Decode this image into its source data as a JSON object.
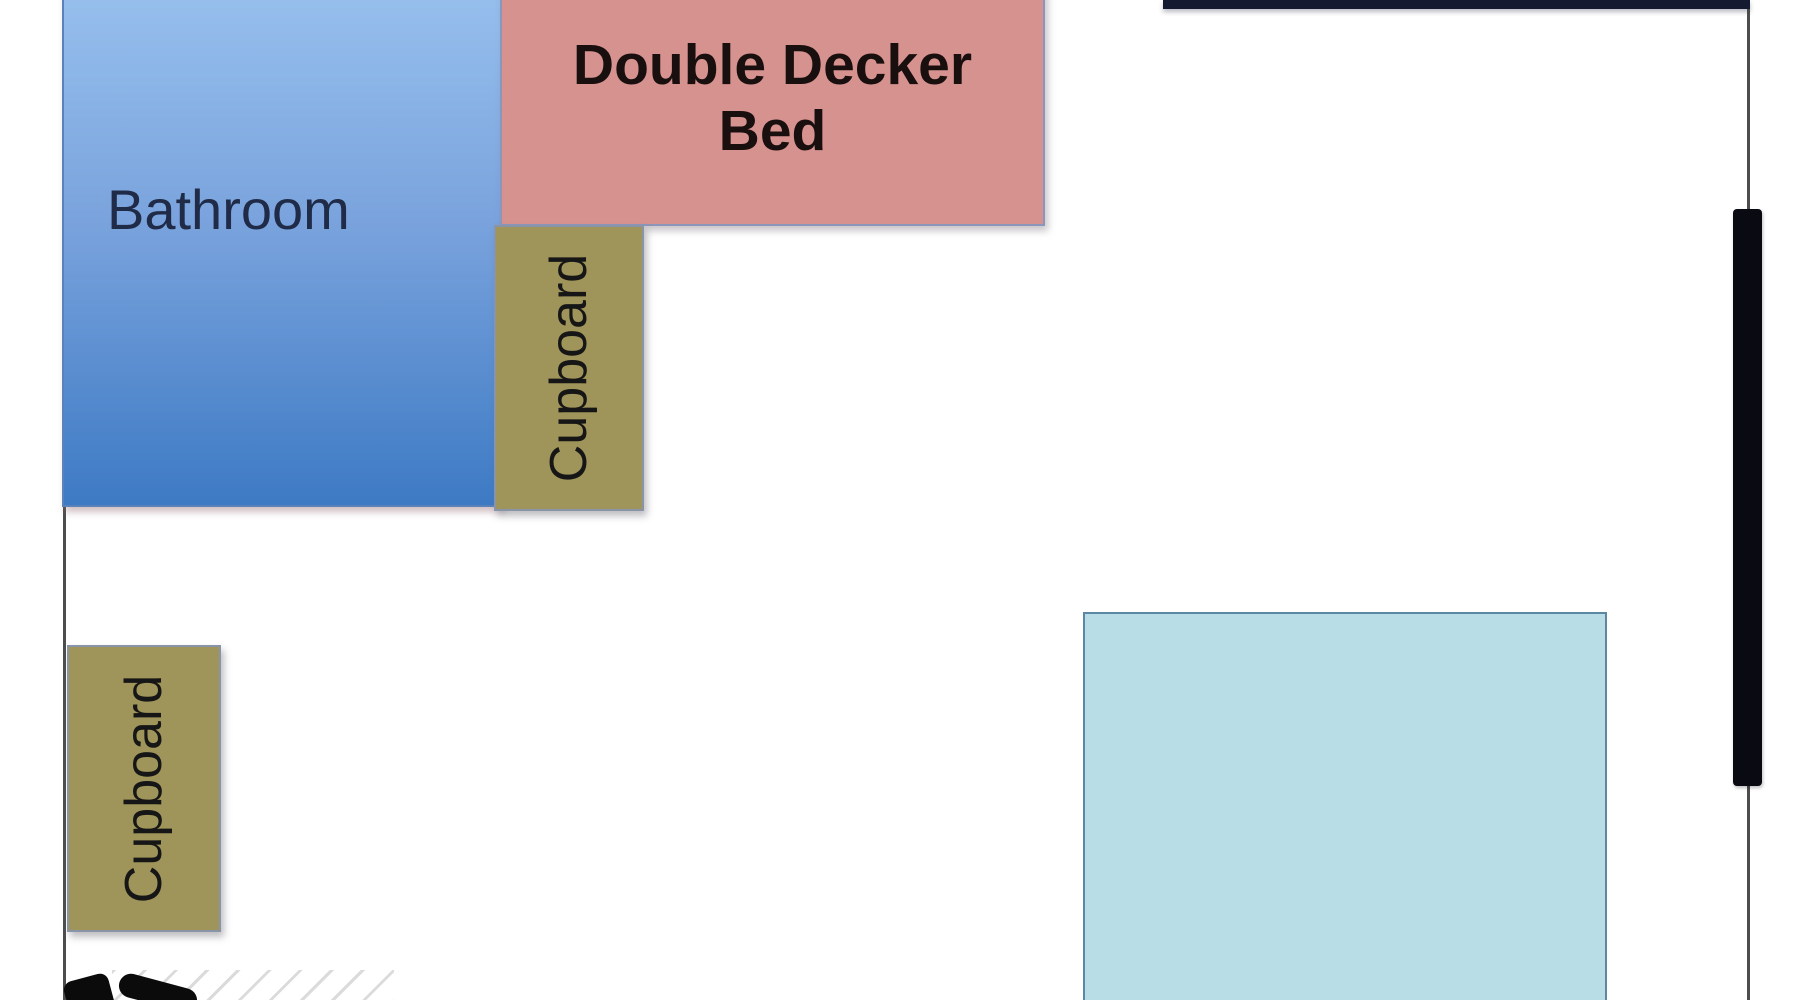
{
  "diagram": {
    "type": "floor-plan",
    "rooms": [
      {
        "id": "bathroom",
        "label": "Bathroom"
      }
    ],
    "furniture": [
      {
        "id": "double-decker-bed",
        "label": "Double Decker Bed"
      },
      {
        "id": "cupboard-right",
        "label": "Cupboard"
      },
      {
        "id": "cupboard-left",
        "label": "Cupboard"
      },
      {
        "id": "unlabeled-area",
        "label": ""
      }
    ],
    "symbols": [
      {
        "id": "window-marker",
        "description": "thick black bar on right wall"
      },
      {
        "id": "door-symbol",
        "description": "black shapes with diagonal hatching, cut off at bottom edge"
      }
    ],
    "colors": {
      "bathroom_fill": "linear-gradient(180deg, #97c0ee 0%, #7aa3dd 45%, #3d7ac4 100%)",
      "bathroom_text": "#1f2b47",
      "bed_fill": "#d6928f",
      "bed_text": "#1a0f0f",
      "cupboard_fill": "#9f9459",
      "cupboard_text": "#161616",
      "area_fill": "#b9dde6",
      "wall_line": "#4d4d4d",
      "top_wall": "#141b31",
      "window_marker": "#0a0a12"
    }
  }
}
